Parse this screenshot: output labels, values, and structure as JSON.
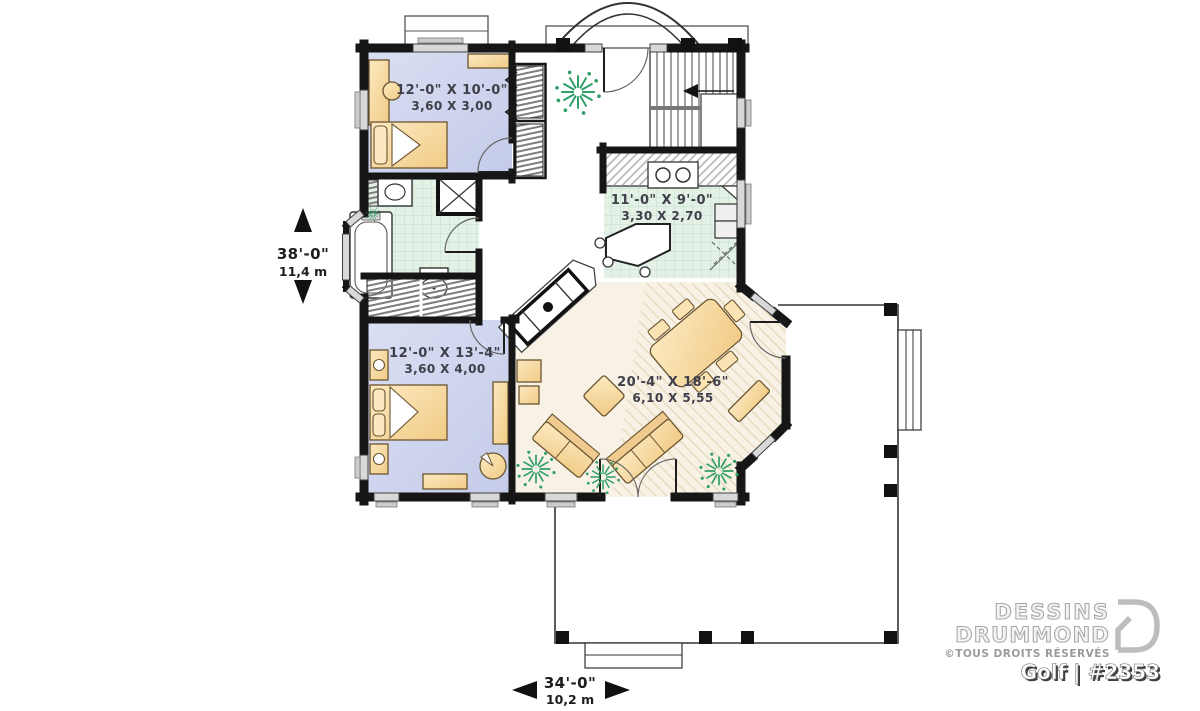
{
  "branding": {
    "name_line1": "DESSINS",
    "name_line2": "DRUMMOND",
    "rights": "©TOUS DROITS RÉSERVÉS",
    "model": "Golf | #2353"
  },
  "rooms": {
    "bedroom_top": {
      "imperial": "12'-0\" X 10'-0\"",
      "metric": "3,60 X 3,00"
    },
    "kitchen": {
      "imperial": "11'-0\" X 9'-0\"",
      "metric": "3,30 X 2,70"
    },
    "bedroom_bottom": {
      "imperial": "12'-0\" X 13'-4\"",
      "metric": "3,60 X 4,00"
    },
    "living": {
      "imperial": "20'-4\" X 18'-6\"",
      "metric": "6,10 X 5,55"
    }
  },
  "overall_dimensions": {
    "depth": {
      "imperial": "38'-0\"",
      "metric": "11,4 m"
    },
    "width": {
      "imperial": "34'-0\"",
      "metric": "10,2 m"
    }
  },
  "colors": {
    "bedroom_floor": "#cdd4ec",
    "living_floor": "#f8f2e6",
    "tile_floor": "#e4f1e7",
    "furniture": "#f6d79e",
    "plant": "#2f9e68",
    "wall": "#161616",
    "logo_gray": "#bdbdbd"
  }
}
